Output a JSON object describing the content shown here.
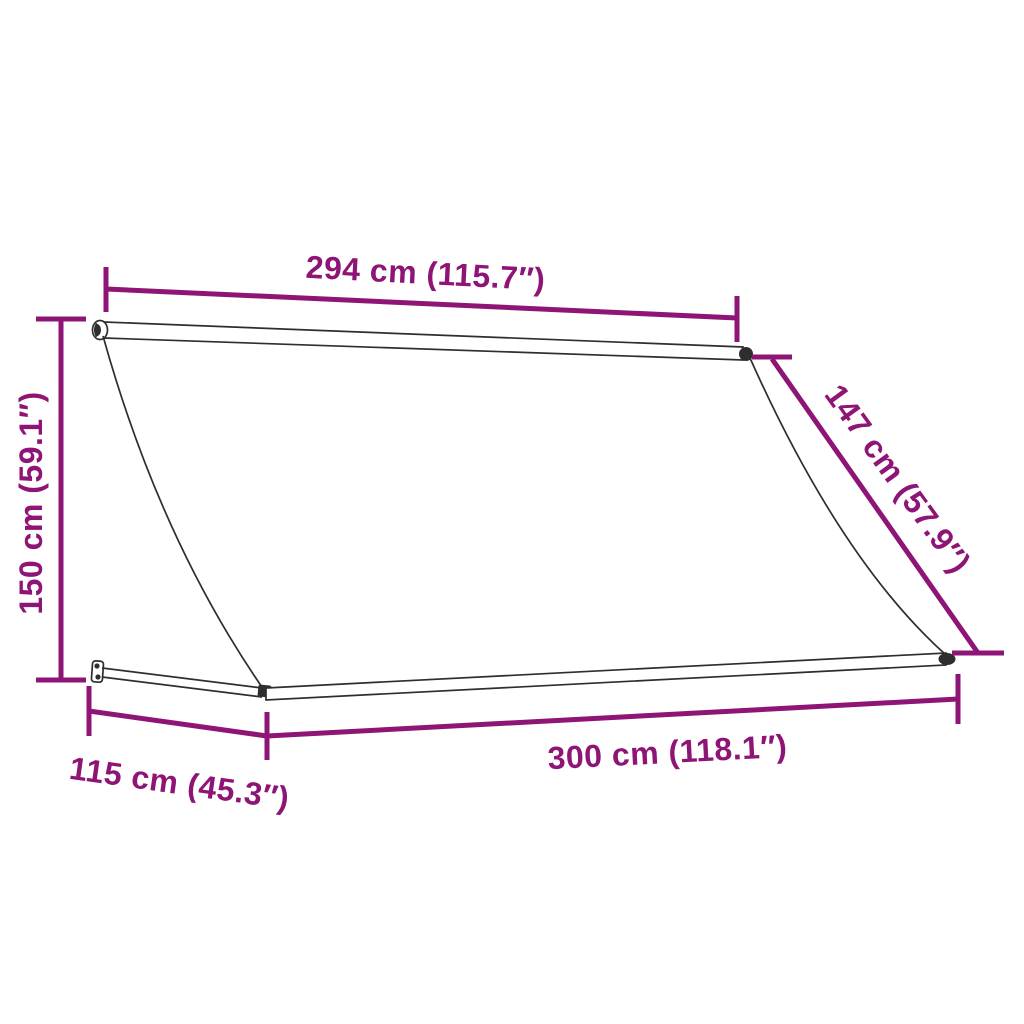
{
  "labels": {
    "top_width": "294 cm (115.7″)",
    "left_height": "150 cm (59.1″)",
    "right_slant": "147 cm (57.9″)",
    "bottom_depth": "115 cm (45.3″)",
    "bottom_width": "300 cm (118.1″)"
  },
  "colors": {
    "dimension": "#8E1476",
    "outline": "#2e2e2e",
    "background": "#ffffff"
  }
}
